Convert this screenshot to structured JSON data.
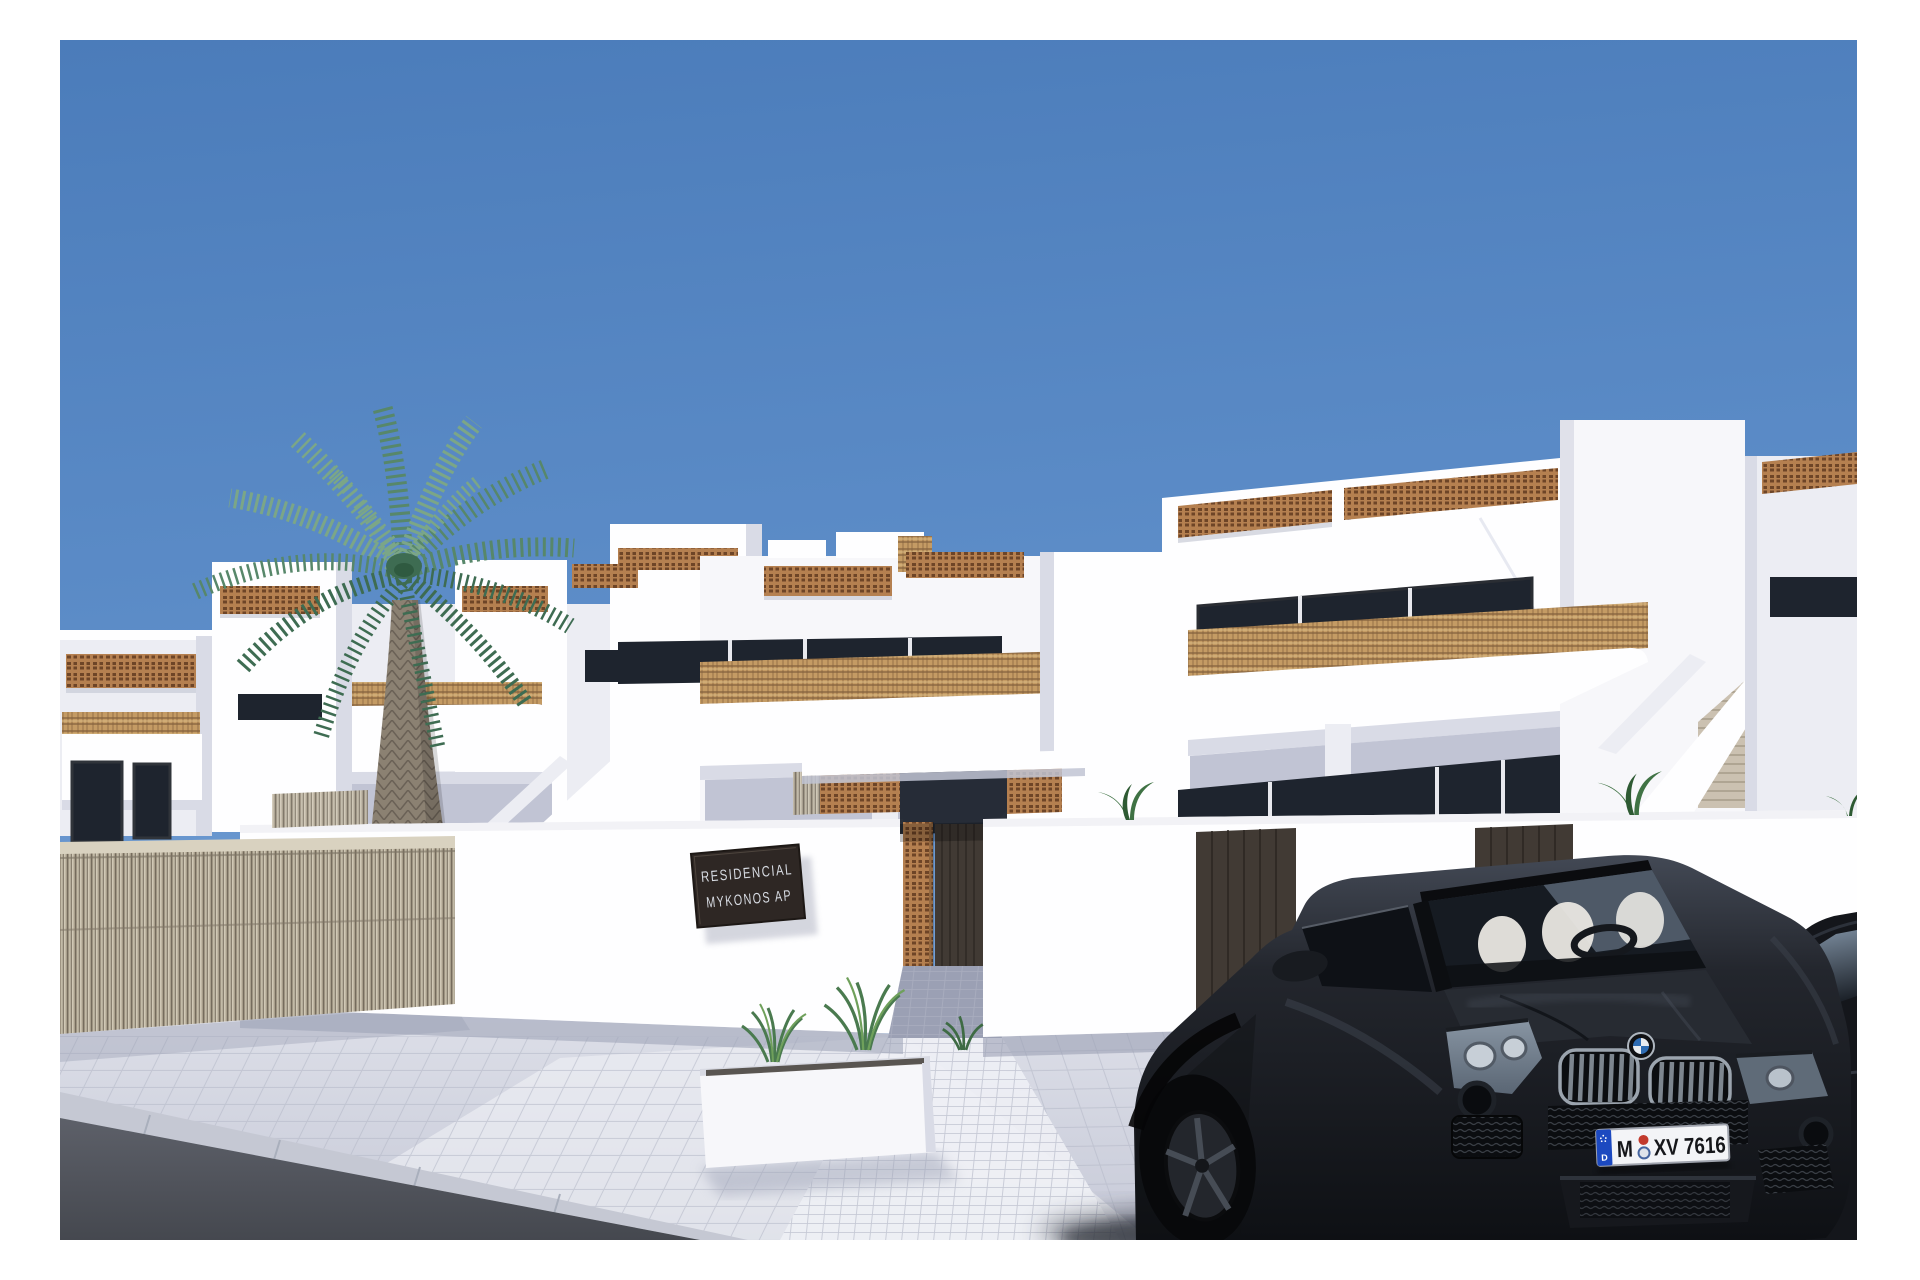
{
  "sign": {
    "line1": "RESIDENCIAL",
    "line2": "MYKONOS AP"
  },
  "license_plate": {
    "eu_band_letter": "D",
    "city_code": "M",
    "number": "XV 7616"
  },
  "colors": {
    "sky_top": "#4B7CBA",
    "sky_mid": "#5E8EC9",
    "sky_horizon": "#85ACDC",
    "wall_bright": "#FEFEFF",
    "wall_white": "#F7F7FA",
    "wall_light": "#ECEDF3",
    "wall_shadow": "#D9DBE6",
    "wall_shadow_deep": "#C1C4D4",
    "wall_recess": "#A6ABBD",
    "lattice_clay": "#B58050",
    "lattice_hole": "#6E4527",
    "rattan": "#C49B64",
    "rattan_dark": "#83603C",
    "reed_light": "#D0C8B5",
    "reed_mid": "#A89E8B",
    "reed_dark": "#756C5D",
    "window_glass": "#1E242E",
    "window_frame": "#2A2D33",
    "glass_reflection": "#93A7BC",
    "door_brown": "#413A34",
    "door_dark": "#2B2520",
    "step_beige": "#CBC1B1",
    "pavement": "#DEE0E9",
    "pavement_deep": "#C7CAD8",
    "pavement_bright": "#EEF0F5",
    "pavement_joint": "#B5B9C8",
    "pavement_shade": "#9BA0B4",
    "curb": "#C5C8D3",
    "asphalt": "#5D6069",
    "asphalt_dark": "#45484F",
    "palm_green_light": "#7BA687",
    "palm_green": "#57876A",
    "palm_green_dark": "#3E6C52",
    "palm_trunk": "#8B8172",
    "palm_trunk_dark": "#6A6156",
    "plant_green": "#3F7244",
    "car_body": "#23262D",
    "car_body_dark": "#0E1014",
    "car_highlight": "#434955",
    "car_glass": "#161B22",
    "seat_white": "#E9E7E2",
    "chrome": "#9BA4AE",
    "grille_dark": "#0B0D10",
    "plate_bg": "#F3F4F7",
    "plate_text": "#15161A",
    "plate_blue": "#1C49C0",
    "sticker_red": "#C23A2D",
    "sticker_blue": "#46659F",
    "roundel_blue": "#2E6CB3",
    "roundel_white": "#E9ECF0",
    "sign_bg": "#2E2724",
    "sign_text": "#D7DBE2",
    "shadow_tint": "#30343F"
  }
}
